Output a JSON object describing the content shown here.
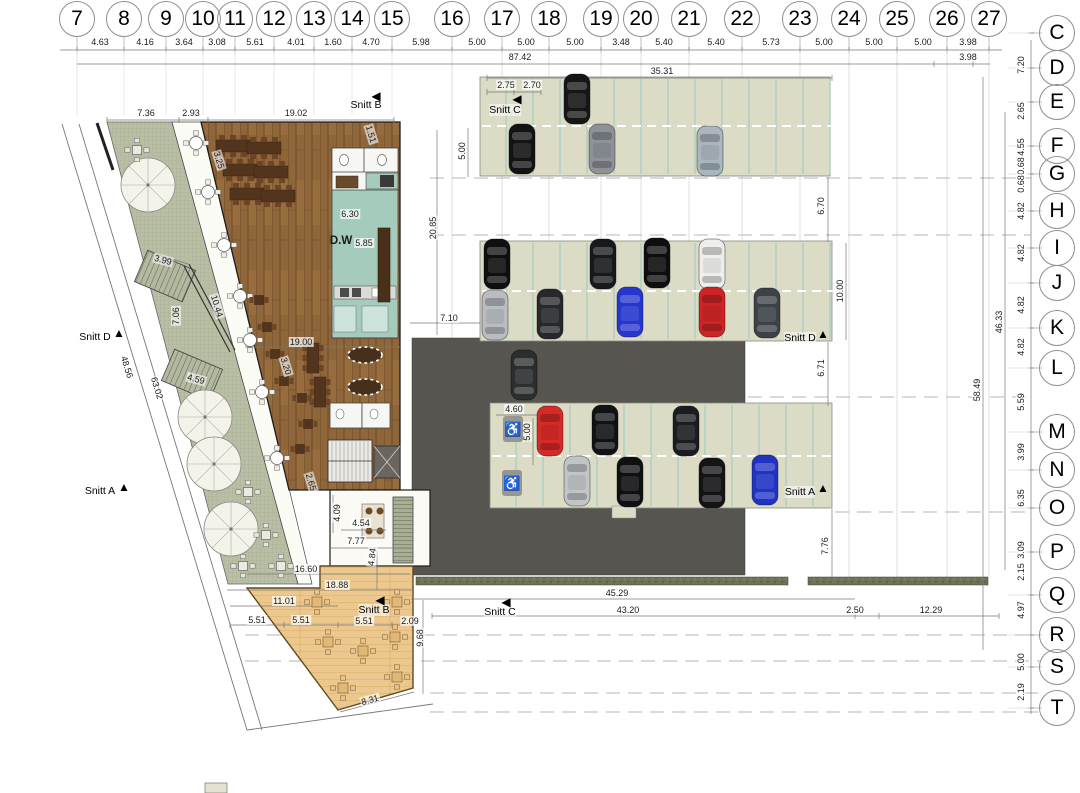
{
  "grid": {
    "top": [
      {
        "n": "7",
        "x": 77
      },
      {
        "n": "8",
        "x": 124
      },
      {
        "n": "9",
        "x": 166
      },
      {
        "n": "10",
        "x": 203
      },
      {
        "n": "11",
        "x": 235
      },
      {
        "n": "12",
        "x": 274
      },
      {
        "n": "13",
        "x": 314
      },
      {
        "n": "14",
        "x": 352
      },
      {
        "n": "15",
        "x": 392
      },
      {
        "n": "16",
        "x": 452
      },
      {
        "n": "17",
        "x": 502
      },
      {
        "n": "18",
        "x": 549
      },
      {
        "n": "19",
        "x": 601
      },
      {
        "n": "20",
        "x": 641
      },
      {
        "n": "21",
        "x": 689
      },
      {
        "n": "22",
        "x": 742
      },
      {
        "n": "23",
        "x": 800
      },
      {
        "n": "24",
        "x": 849
      },
      {
        "n": "25",
        "x": 897
      },
      {
        "n": "26",
        "x": 947
      },
      {
        "n": "27",
        "x": 989
      }
    ],
    "right": [
      {
        "n": "C",
        "y": 33
      },
      {
        "n": "D",
        "y": 68
      },
      {
        "n": "E",
        "y": 102
      },
      {
        "n": "F",
        "y": 146
      },
      {
        "n": "G",
        "y": 174
      },
      {
        "n": "H",
        "y": 211
      },
      {
        "n": "I",
        "y": 248
      },
      {
        "n": "J",
        "y": 283
      },
      {
        "n": "K",
        "y": 328
      },
      {
        "n": "L",
        "y": 368
      },
      {
        "n": "M",
        "y": 432
      },
      {
        "n": "N",
        "y": 470
      },
      {
        "n": "O",
        "y": 508
      },
      {
        "n": "P",
        "y": 552
      },
      {
        "n": "Q",
        "y": 595
      },
      {
        "n": "R",
        "y": 635
      },
      {
        "n": "S",
        "y": 667
      },
      {
        "n": "T",
        "y": 708
      }
    ]
  },
  "dims_top": [
    {
      "t": "4.63",
      "x": 100
    },
    {
      "t": "4.16",
      "x": 145
    },
    {
      "t": "3.64",
      "x": 184
    },
    {
      "t": "3.08",
      "x": 217
    },
    {
      "t": "5.61",
      "x": 255
    },
    {
      "t": "4.01",
      "x": 296
    },
    {
      "t": "1.60",
      "x": 333
    },
    {
      "t": "4.70",
      "x": 371
    },
    {
      "t": "5.98",
      "x": 421
    },
    {
      "t": "5.00",
      "x": 477
    },
    {
      "t": "5.00",
      "x": 526
    },
    {
      "t": "5.00",
      "x": 575
    },
    {
      "t": "3.48",
      "x": 621
    },
    {
      "t": "5.40",
      "x": 664
    },
    {
      "t": "5.40",
      "x": 716
    },
    {
      "t": "5.73",
      "x": 771
    },
    {
      "t": "5.00",
      "x": 824
    },
    {
      "t": "5.00",
      "x": 874
    },
    {
      "t": "5.00",
      "x": 923
    },
    {
      "t": "3.98",
      "x": 968
    }
  ],
  "dims_right": [
    {
      "t": "7.20",
      "y": 65
    },
    {
      "t": "2.65",
      "y": 111
    },
    {
      "t": "4.55",
      "y": 147
    },
    {
      "t": "0.68",
      "y": 166
    },
    {
      "t": "0.68",
      "y": 184
    },
    {
      "t": "4.82",
      "y": 211
    },
    {
      "t": "4.82",
      "y": 253
    },
    {
      "t": "4.82",
      "y": 305
    },
    {
      "t": "4.82",
      "y": 347
    },
    {
      "t": "5.59",
      "y": 402
    },
    {
      "t": "3.99",
      "y": 452
    },
    {
      "t": "6.35",
      "y": 498
    },
    {
      "t": "3.09",
      "y": 550
    },
    {
      "t": "2.15",
      "y": 572
    },
    {
      "t": "4.97",
      "y": 610
    },
    {
      "t": "5.00",
      "y": 662
    },
    {
      "t": "2.19",
      "y": 692
    }
  ],
  "labels": [
    {
      "t": "87.42",
      "x": 520,
      "y": 57
    },
    {
      "t": "3.98",
      "x": 968,
      "y": 57
    },
    {
      "t": "35.31",
      "x": 662,
      "y": 71
    },
    {
      "t": "2.75",
      "x": 506,
      "y": 85
    },
    {
      "t": "2.70",
      "x": 532,
      "y": 85
    },
    {
      "t": "7.36",
      "x": 146,
      "y": 113
    },
    {
      "t": "2.93",
      "x": 191,
      "y": 113
    },
    {
      "t": "19.02",
      "x": 296,
      "y": 113
    },
    {
      "t": "5.00",
      "x": 462,
      "y": 151,
      "r": -90
    },
    {
      "t": "1.51",
      "x": 371,
      "y": 134,
      "r": 73
    },
    {
      "t": "3.25",
      "x": 219,
      "y": 160,
      "r": 73
    },
    {
      "t": "6.30",
      "x": 350,
      "y": 214
    },
    {
      "t": "D.W",
      "x": 341,
      "y": 241,
      "cls": "big"
    },
    {
      "t": "5.85",
      "x": 364,
      "y": 243
    },
    {
      "t": "20.85",
      "x": 433,
      "y": 228,
      "r": -90
    },
    {
      "t": "3.99",
      "x": 163,
      "y": 260,
      "r": 15
    },
    {
      "t": "10.44",
      "x": 217,
      "y": 306,
      "r": 73
    },
    {
      "t": "7.06",
      "x": 176,
      "y": 316,
      "r": -90
    },
    {
      "t": "7.10",
      "x": 449,
      "y": 318
    },
    {
      "t": "19.00",
      "x": 301,
      "y": 342
    },
    {
      "t": "3.20",
      "x": 286,
      "y": 366,
      "r": 73
    },
    {
      "t": "48.56",
      "x": 127,
      "y": 367,
      "r": 73
    },
    {
      "t": "63.02",
      "x": 157,
      "y": 388,
      "r": 73
    },
    {
      "t": "4.59",
      "x": 196,
      "y": 379,
      "r": 15
    },
    {
      "t": "6.70",
      "x": 821,
      "y": 206,
      "r": -90
    },
    {
      "t": "10.00",
      "x": 840,
      "y": 291,
      "r": -90
    },
    {
      "t": "6.71",
      "x": 821,
      "y": 368,
      "r": -90
    },
    {
      "t": "46.33",
      "x": 999,
      "y": 322,
      "r": -90
    },
    {
      "t": "58.49",
      "x": 977,
      "y": 390,
      "r": -90
    },
    {
      "t": "4.60",
      "x": 514,
      "y": 409
    },
    {
      "t": "5.00",
      "x": 527,
      "y": 432,
      "r": -90
    },
    {
      "t": "2.65",
      "x": 311,
      "y": 482,
      "r": 73
    },
    {
      "t": "4.09",
      "x": 337,
      "y": 513,
      "r": -90
    },
    {
      "t": "4.54",
      "x": 361,
      "y": 523
    },
    {
      "t": "7.77",
      "x": 356,
      "y": 541
    },
    {
      "t": "4.84",
      "x": 372,
      "y": 557,
      "r": -83
    },
    {
      "t": "7.76",
      "x": 825,
      "y": 546,
      "r": -90
    },
    {
      "t": "16.60",
      "x": 306,
      "y": 569
    },
    {
      "t": "18.88",
      "x": 337,
      "y": 585
    },
    {
      "t": "45.29",
      "x": 617,
      "y": 593
    },
    {
      "t": "11.01",
      "x": 284,
      "y": 601
    },
    {
      "t": "43.20",
      "x": 628,
      "y": 610
    },
    {
      "t": "2.50",
      "x": 855,
      "y": 610
    },
    {
      "t": "12.29",
      "x": 931,
      "y": 610
    },
    {
      "t": "5.51",
      "x": 257,
      "y": 620
    },
    {
      "t": "5.51",
      "x": 301,
      "y": 620
    },
    {
      "t": "5.51",
      "x": 364,
      "y": 621
    },
    {
      "t": "2.09",
      "x": 410,
      "y": 621
    },
    {
      "t": "9.68",
      "x": 420,
      "y": 638,
      "r": -90
    },
    {
      "t": "8.31",
      "x": 370,
      "y": 700,
      "r": -16
    }
  ],
  "sections": [
    {
      "label": "Snitt B",
      "tx": 366,
      "ty": 105,
      "arrow": "left",
      "ax": 376,
      "ay": 96
    },
    {
      "label": "Snitt C",
      "tx": 505,
      "ty": 110,
      "arrow": "left",
      "ax": 517,
      "ay": 99
    },
    {
      "label": "Snitt D",
      "tx": 95,
      "ty": 337,
      "arrow": "up",
      "ax": 119,
      "ay": 333
    },
    {
      "label": "Snitt A",
      "tx": 100,
      "ty": 491,
      "arrow": "up",
      "ax": 124,
      "ay": 487
    },
    {
      "label": "Snitt D",
      "tx": 800,
      "ty": 338,
      "arrow": "up",
      "ax": 823,
      "ay": 334
    },
    {
      "label": "Snitt A",
      "tx": 800,
      "ty": 492,
      "arrow": "up",
      "ax": 823,
      "ay": 488
    },
    {
      "label": "Snitt B",
      "tx": 374,
      "ty": 610,
      "arrow": "left",
      "ax": 380,
      "ay": 600
    },
    {
      "label": "Snitt C",
      "tx": 500,
      "ty": 612,
      "arrow": "left",
      "ax": 506,
      "ay": 602
    }
  ],
  "cars": [
    {
      "x": 577,
      "y": 99,
      "c": "#161616"
    },
    {
      "x": 522,
      "y": 149,
      "c": "#131313"
    },
    {
      "x": 602,
      "y": 149,
      "c": "#8d9298"
    },
    {
      "x": 710,
      "y": 151,
      "c": "#aab6be"
    },
    {
      "x": 497,
      "y": 264,
      "c": "#0f0f10"
    },
    {
      "x": 603,
      "y": 264,
      "c": "#17191d"
    },
    {
      "x": 657,
      "y": 263,
      "c": "#0e0e0f"
    },
    {
      "x": 712,
      "y": 264,
      "c": "#eeeeec",
      "s": "#777777"
    },
    {
      "x": 495,
      "y": 315,
      "c": "#b9bcc0"
    },
    {
      "x": 550,
      "y": 314,
      "c": "#26282c"
    },
    {
      "x": 630,
      "y": 312,
      "c": "#2637cf"
    },
    {
      "x": 712,
      "y": 312,
      "c": "#cf2425"
    },
    {
      "x": 767,
      "y": 313,
      "c": "#3d4248"
    },
    {
      "x": 550,
      "y": 431,
      "c": "#d52a26"
    },
    {
      "x": 605,
      "y": 430,
      "c": "#111214"
    },
    {
      "x": 686,
      "y": 431,
      "c": "#1a1c1f"
    },
    {
      "x": 577,
      "y": 481,
      "c": "#c2c5c8"
    },
    {
      "x": 630,
      "y": 482,
      "c": "#101013"
    },
    {
      "x": 712,
      "y": 483,
      "c": "#141417"
    },
    {
      "x": 765,
      "y": 480,
      "c": "#2133c4"
    },
    {
      "x": 524,
      "y": 375,
      "c": "#2c2d2e"
    }
  ],
  "accessible_icons": [
    {
      "x": 513,
      "y": 429,
      "glyph": "♿"
    },
    {
      "x": 512,
      "y": 483,
      "glyph": "♿"
    }
  ],
  "furniture": {
    "parasols": [
      [
        148,
        185
      ],
      [
        205,
        417
      ],
      [
        214,
        464
      ],
      [
        231,
        529
      ]
    ],
    "walkway_tables": [
      [
        196,
        143
      ],
      [
        208,
        192
      ],
      [
        224,
        245
      ],
      [
        240,
        296
      ],
      [
        250,
        340
      ],
      [
        262,
        392
      ],
      [
        277,
        458
      ]
    ],
    "terrace_tables": [
      [
        137,
        150
      ],
      [
        248,
        492
      ],
      [
        266,
        535
      ],
      [
        243,
        566
      ],
      [
        281,
        566
      ]
    ],
    "tan_tables": [
      [
        317,
        602
      ],
      [
        397,
        602
      ],
      [
        328,
        642
      ],
      [
        363,
        651
      ],
      [
        395,
        637
      ],
      [
        397,
        677
      ],
      [
        343,
        688
      ]
    ],
    "rect_tables": [
      [
        233,
        146
      ],
      [
        264,
        148
      ],
      [
        240,
        170
      ],
      [
        271,
        172
      ],
      [
        247,
        194
      ],
      [
        278,
        196
      ]
    ],
    "vrect_tables": [
      [
        313,
        358
      ],
      [
        320,
        392
      ]
    ],
    "small_tables": [
      [
        259,
        300
      ],
      [
        267,
        327
      ],
      [
        275,
        354
      ],
      [
        284,
        381
      ],
      [
        302,
        398
      ],
      [
        308,
        424
      ],
      [
        300,
        449
      ]
    ],
    "ovals": [
      [
        365,
        355
      ],
      [
        365,
        387
      ]
    ]
  },
  "palette": {
    "terrace_green": "#b9bfa4",
    "walkway": "#fcfcf7",
    "wood_floor": "#8f653a",
    "kitchen_teal": "#a5cbbd",
    "parking_beige": "#dcdbc6",
    "stall_teal": "#a9cfc4",
    "garage_dark": "#56554f",
    "tan_terrace": "#ecc88e",
    "hedge_green": "#6e7258"
  }
}
